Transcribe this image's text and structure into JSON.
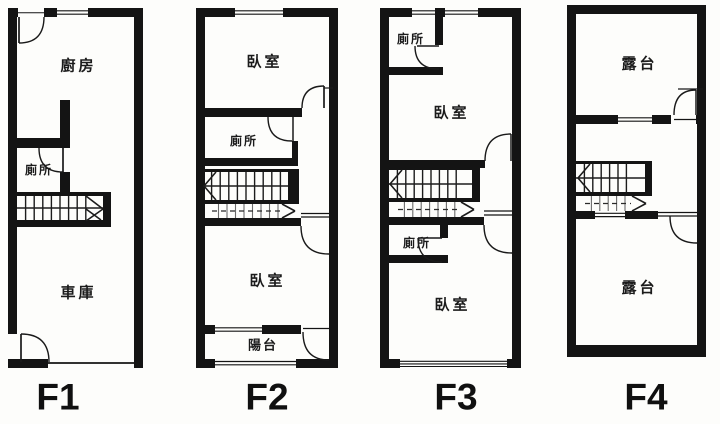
{
  "floor_plan": {
    "colors": {
      "wall": "#141414",
      "background": "#fdfdfb",
      "text": "#1b1b1b"
    },
    "floors": [
      {
        "id": "F1",
        "label": "F1",
        "rooms": [
          {
            "key": "kitchen",
            "label": "廚房"
          },
          {
            "key": "toilet",
            "label": "廁所"
          },
          {
            "key": "garage",
            "label": "車庫"
          }
        ]
      },
      {
        "id": "F2",
        "label": "F2",
        "rooms": [
          {
            "key": "bedroom-upper",
            "label": "臥室"
          },
          {
            "key": "toilet",
            "label": "廁所"
          },
          {
            "key": "bedroom-lower",
            "label": "臥室"
          },
          {
            "key": "balcony",
            "label": "陽台"
          }
        ]
      },
      {
        "id": "F3",
        "label": "F3",
        "rooms": [
          {
            "key": "toilet-upper",
            "label": "廁所"
          },
          {
            "key": "bedroom-upper",
            "label": "臥室"
          },
          {
            "key": "toilet-lower",
            "label": "廁所"
          },
          {
            "key": "bedroom-lower",
            "label": "臥室"
          }
        ]
      },
      {
        "id": "F4",
        "label": "F4",
        "rooms": [
          {
            "key": "terrace-upper",
            "label": "露台"
          },
          {
            "key": "terrace-lower",
            "label": "露台"
          }
        ]
      }
    ]
  }
}
